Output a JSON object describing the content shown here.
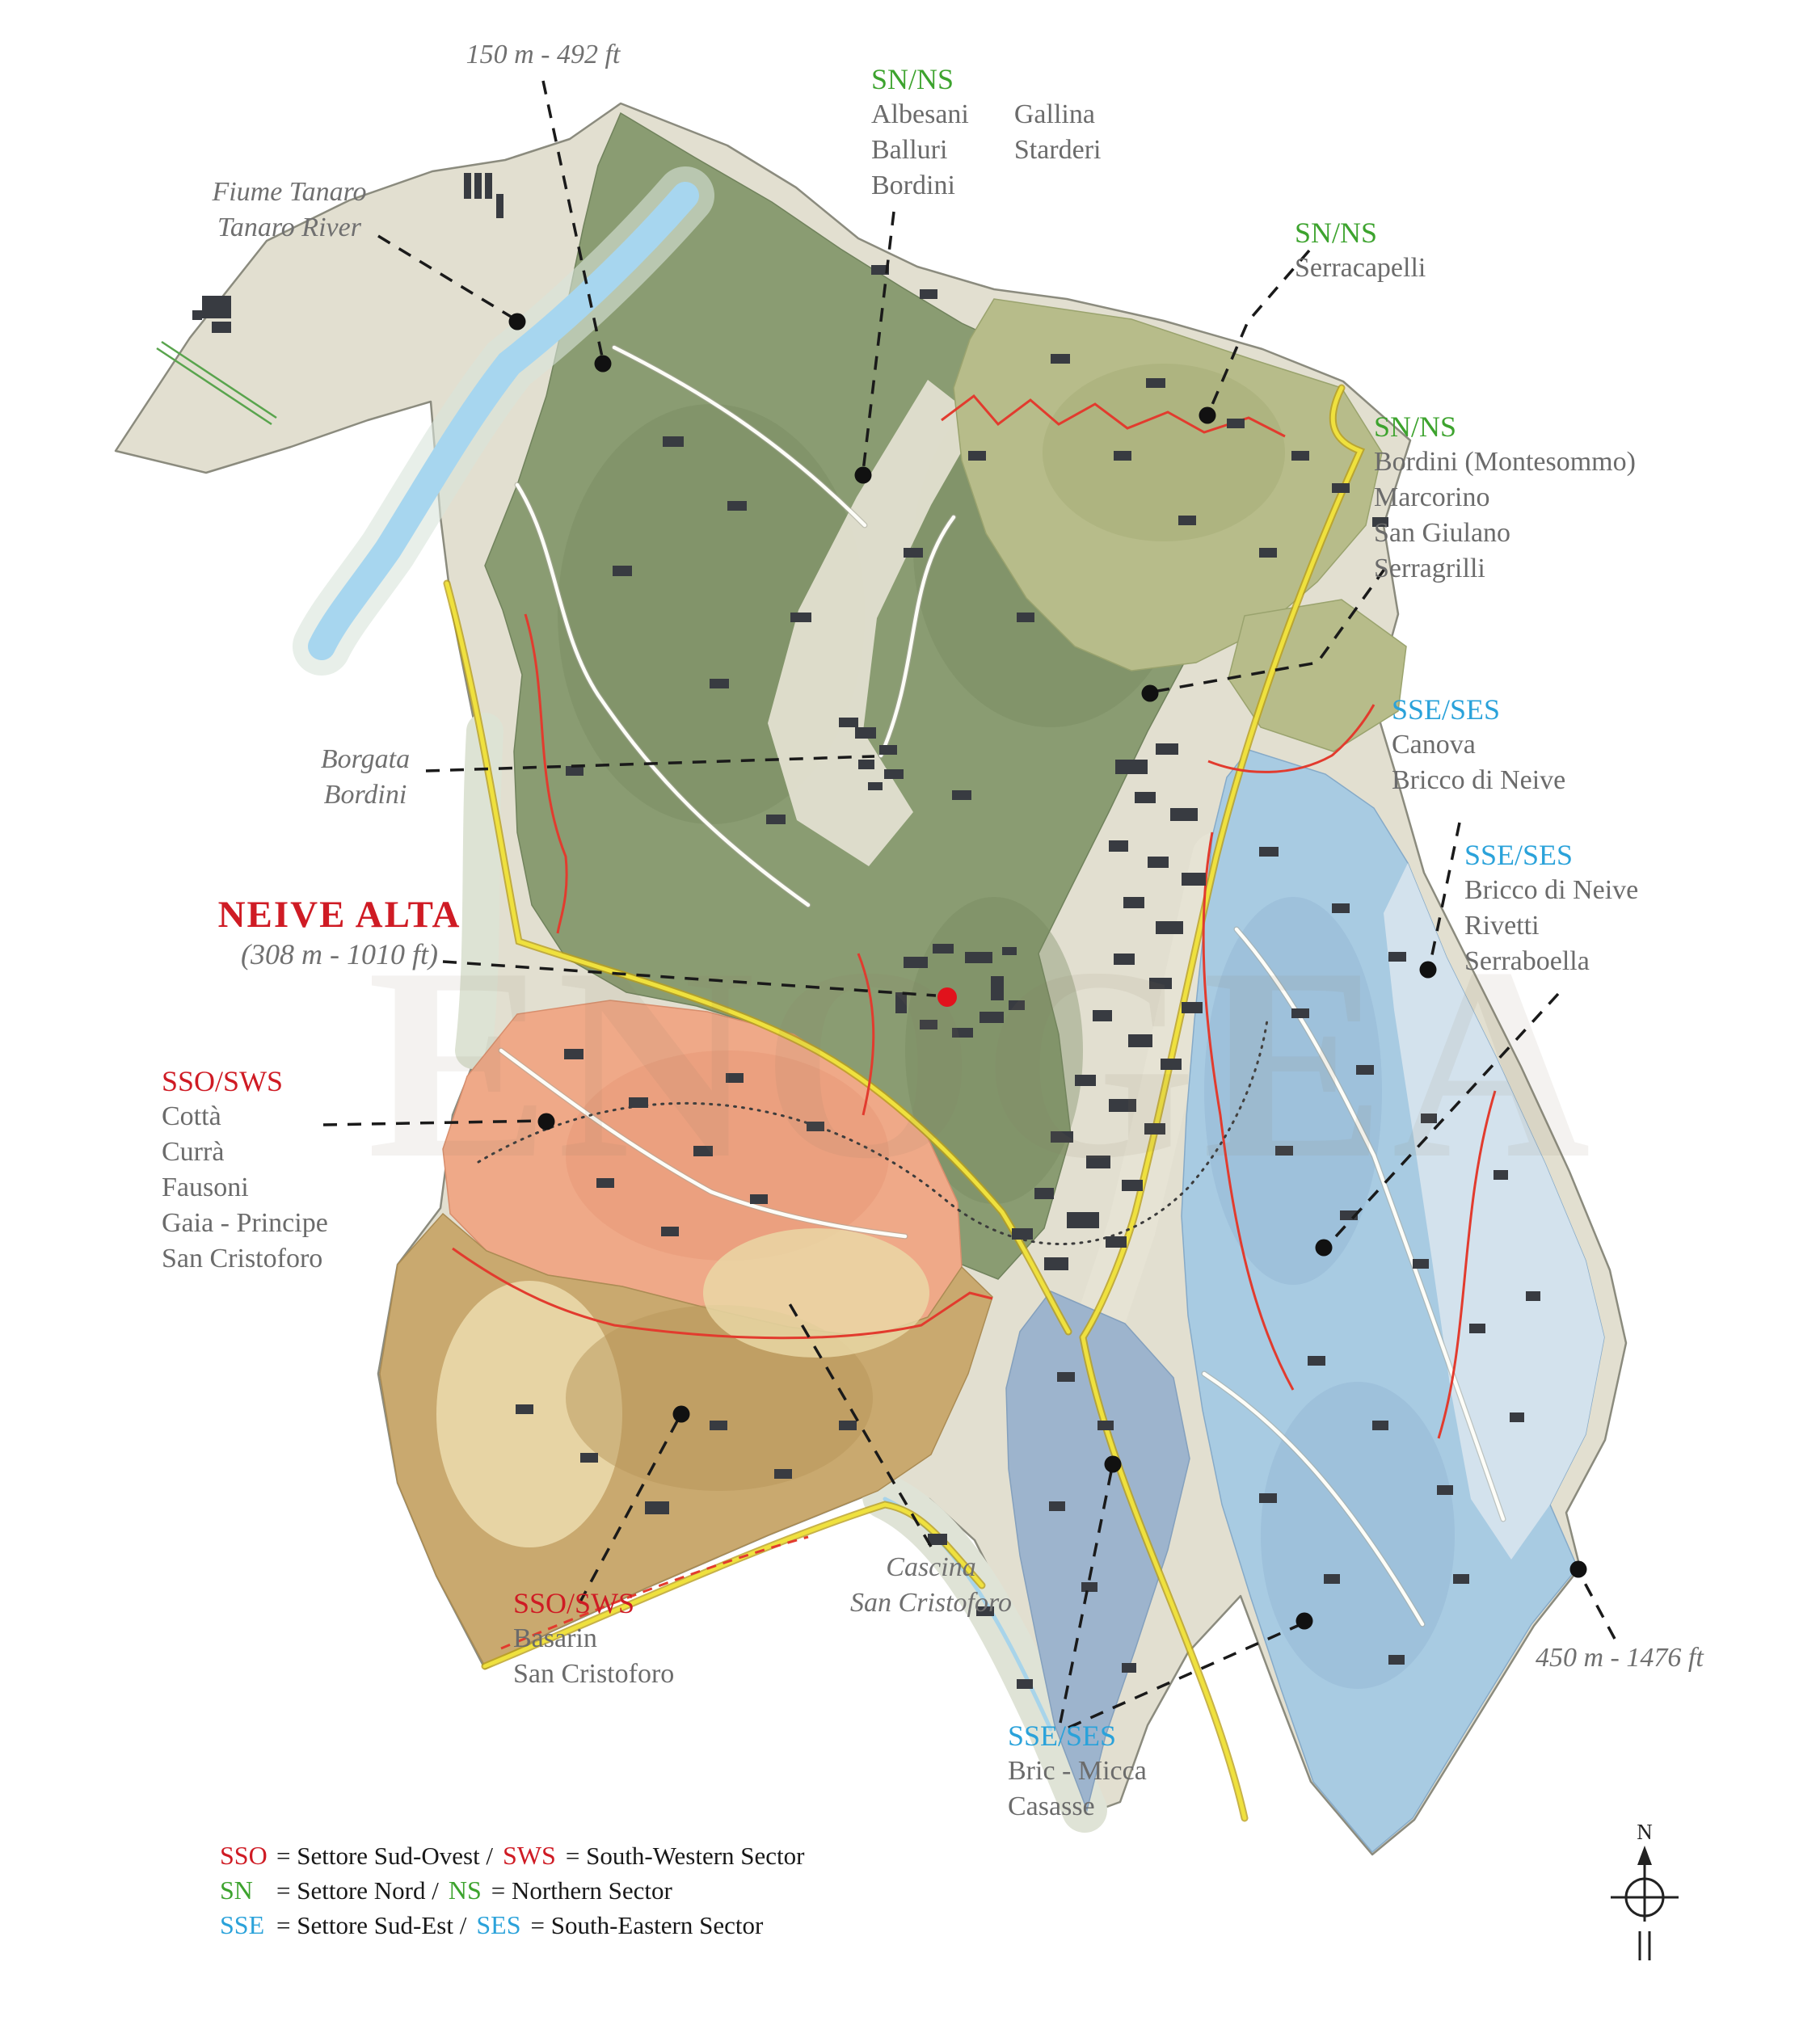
{
  "labels": {
    "elevation_min": {
      "text": "150 m - 492 ft"
    },
    "river": {
      "line1": "Fiume Tanaro",
      "line2": "Tanaro River"
    },
    "sector_north_albesani": {
      "code": "SN/NS",
      "col1": [
        "Albesani",
        "Balluri",
        "Bordini"
      ],
      "col2": [
        "Gallina",
        "Starderi"
      ]
    },
    "sector_north_serracapelli": {
      "code": "SN/NS",
      "names": [
        "Serracapelli"
      ]
    },
    "sector_north_bordini": {
      "code": "SN/NS",
      "names": [
        "Bordini (Montesommo)",
        "Marcorino",
        "San Giulano",
        "Serragrilli"
      ]
    },
    "sector_se_canova": {
      "code": "SSE/SES",
      "names": [
        "Canova",
        "Bricco di Neive"
      ]
    },
    "sector_se_bricco": {
      "code": "SSE/SES",
      "names": [
        "Bricco di Neive",
        "Rivetti",
        "Serraboella"
      ]
    },
    "neive_alta": {
      "title": "NEIVE ALTA",
      "subtitle": "(308 m - 1010 ft)"
    },
    "borgata_bordini": {
      "line1": "Borgata",
      "line2": "Bordini"
    },
    "sector_sw_cotta": {
      "code": "SSO/SWS",
      "names": [
        "Cottà",
        "Currà",
        "Fausoni",
        "Gaia - Principe",
        "San Cristoforo"
      ]
    },
    "sector_sw_basarin": {
      "code": "SSO/SWS",
      "names": [
        "Basarin",
        "San Cristoforo"
      ]
    },
    "cascina": {
      "line1": "Cascina",
      "line2": "San Cristoforo"
    },
    "sector_se_bric": {
      "code": "SSE/SES",
      "names": [
        "Bric - Micca",
        "Casasse"
      ]
    },
    "elevation_max": {
      "text": "450 m - 1476 ft"
    }
  },
  "legend": {
    "rows": [
      {
        "code1": "SSO",
        "text1": "= Settore Sud-Ovest /",
        "code2": "SWS",
        "text2": "= South-Western Sector"
      },
      {
        "code1": "SN",
        "text1": "= Settore Nord /",
        "code2": "NS",
        "text2": "= Northern Sector"
      },
      {
        "code1": "SSE",
        "text1": "= Settore Sud-Est /",
        "code2": "SES",
        "text2": "= South-Eastern Sector"
      }
    ]
  },
  "compass": {
    "north_label": "N"
  },
  "watermark": {
    "text": "ENOGEA"
  },
  "colors": {
    "sw_red": "#cf1b24",
    "north_green": "#3da32e",
    "se_blue": "#2aa2da",
    "neive_dot": "#e1121c",
    "sector_dark_green": "#8a9c72",
    "sector_olive": "#b7bc8a",
    "sector_light_blue": "#a8cbe2",
    "sector_slate_blue": "#9db4cd",
    "sector_orange": "#efa988",
    "sector_tan": "#c9a96f",
    "river_blue": "#a7d6ef",
    "road_yellow": "#efe13e"
  }
}
